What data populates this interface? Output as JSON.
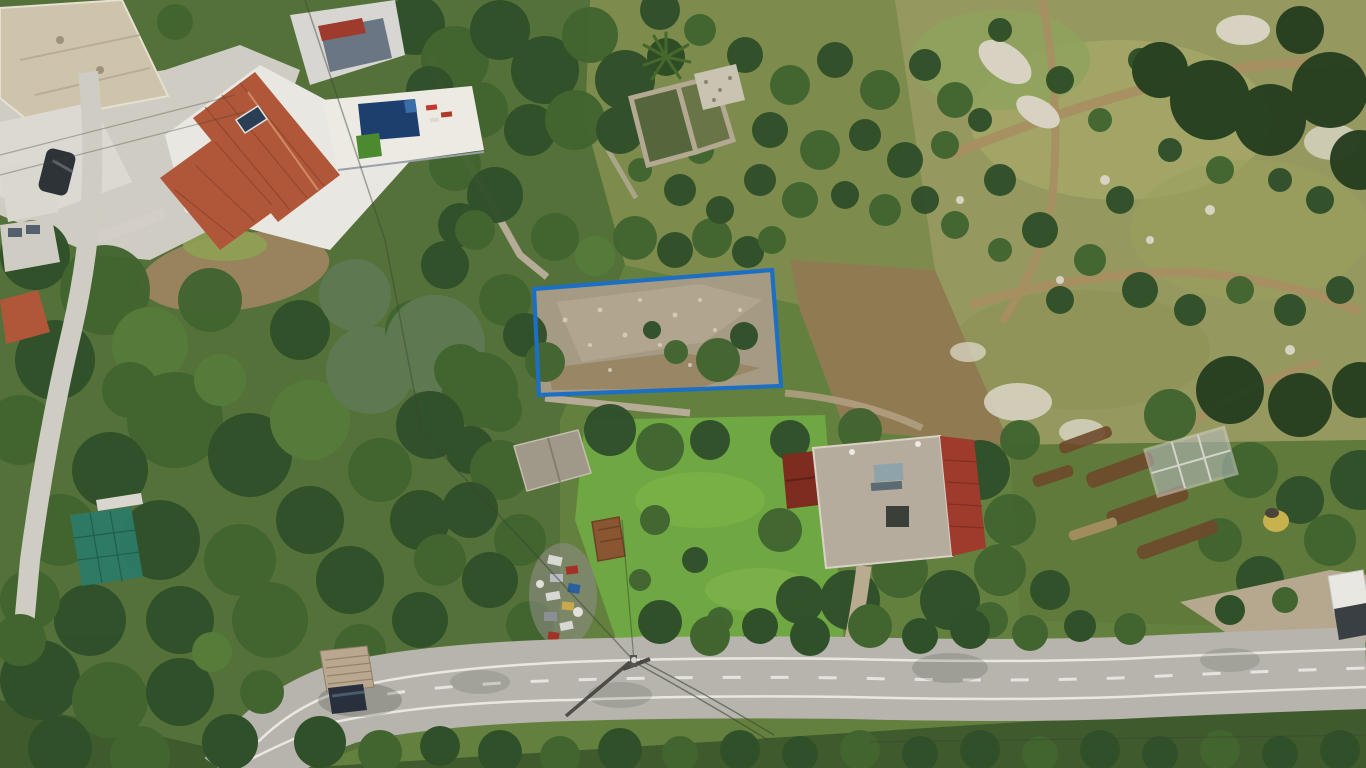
{
  "scene": {
    "description": "Aerial drone photograph of a Mediterranean hillside settlement: a land parcel outlined with a blue boundary rectangle over rocky scrub ground, surrounded by olive trees, a white villa with terracotta roof and swimming pool at top left, old stone ruins with a palm tree at top centre, a flat-roofed house with red tile edge at centre right, garden terraces on the right hillside, a junk pile and sheds in the middle, and a curving asphalt road with white markings, a canopied truck and a utility pole along the bottom.",
    "type": "aerial-photograph",
    "features": [
      "plot-boundary-annotation",
      "villa-terracotta-roof",
      "swimming-pool",
      "pool-terrace",
      "stone-ruins",
      "palm-tree",
      "flat-roof-house",
      "red-tile-roof",
      "maroon-shed",
      "solar-water-heater",
      "gray-shed",
      "rusty-shed",
      "junk-pile",
      "shade-net-structure",
      "main-road",
      "road-center-dashes",
      "road-edge-lines",
      "truck-with-canopy",
      "parked-dark-car",
      "white-pickup",
      "utility-pole",
      "power-lines",
      "olive-grove",
      "rocky-hillside",
      "dirt-paths",
      "garden-beds",
      "greenhouse-frame",
      "green-meadow",
      "stone-walls",
      "narrow-concrete-road"
    ]
  },
  "annotations": {
    "plot_outline": {
      "points": "534,289 772,270 781,386 539,395",
      "color": "#1c6fc2",
      "meaning": "land parcel boundary"
    }
  },
  "colors": {
    "plot_blue": "#1c6fc2",
    "pool_blue": "#1d3f6e",
    "roof_terracotta": "#b0573a",
    "roof_red": "#9e3b2c",
    "roof_maroon": "#7e2b20",
    "roof_flat": "#b6ac9d",
    "roof_tan": "#cec3ab",
    "road": "#b7b4ad",
    "road_line": "#eeece6",
    "concrete": "#cfccc3",
    "meadow": "#6fa742",
    "hillside": "#96995f",
    "grove_ground": "#7d8c4c",
    "forest_base": "#55713a",
    "dirt": "#9b7c55",
    "stone_ground": "#a59a84",
    "shade_net": "#2c7a66",
    "junk_red": "#a33226",
    "junk_blue": "#2b5f9e"
  }
}
